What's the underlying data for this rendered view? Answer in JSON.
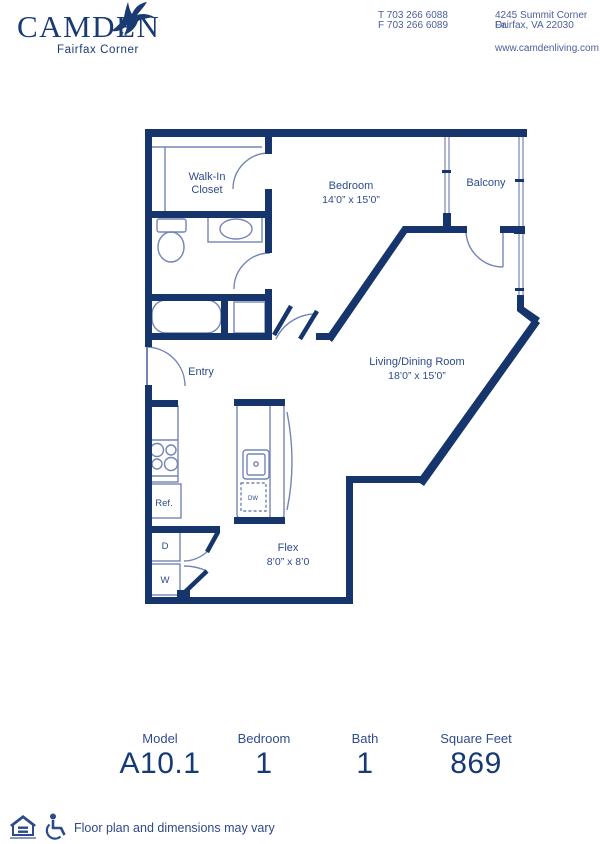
{
  "header": {
    "brand": "CAMDEN",
    "community": "Fairfax Corner",
    "phone_line1": "T 703 266 6088",
    "phone_line2": "F 703 266 6089",
    "address_line1": "4245 Summit Corner Dr.",
    "address_line2": "Fairfax, VA 22030",
    "website": "www.camdenliving.com"
  },
  "plan": {
    "walk_in_closet_line1": "Walk-In",
    "walk_in_closet_line2": "Closet",
    "bedroom_name": "Bedroom",
    "bedroom_dims": "14’0” x 15’0”",
    "balcony_name": "Balcony",
    "entry_name": "Entry",
    "living_name": "Living/Dining Room",
    "living_dims": "18’0” x 15’0”",
    "flex_name": "Flex",
    "flex_dims": "8’0” x 8’0",
    "fridge": "Ref.",
    "dryer": "D",
    "washer": "W",
    "dishwasher": "DW"
  },
  "stats": [
    {
      "label": "Model",
      "value": "A10.1"
    },
    {
      "label": "Bedroom",
      "value": "1"
    },
    {
      "label": "Bath",
      "value": "1"
    },
    {
      "label": "Square Feet",
      "value": "869"
    }
  ],
  "footer": {
    "disclaimer": "Floor plan and dimensions may vary"
  },
  "colors": {
    "wall": "#17356d",
    "thin_line": "#7485b5",
    "label_text": "#2d4b8d"
  }
}
